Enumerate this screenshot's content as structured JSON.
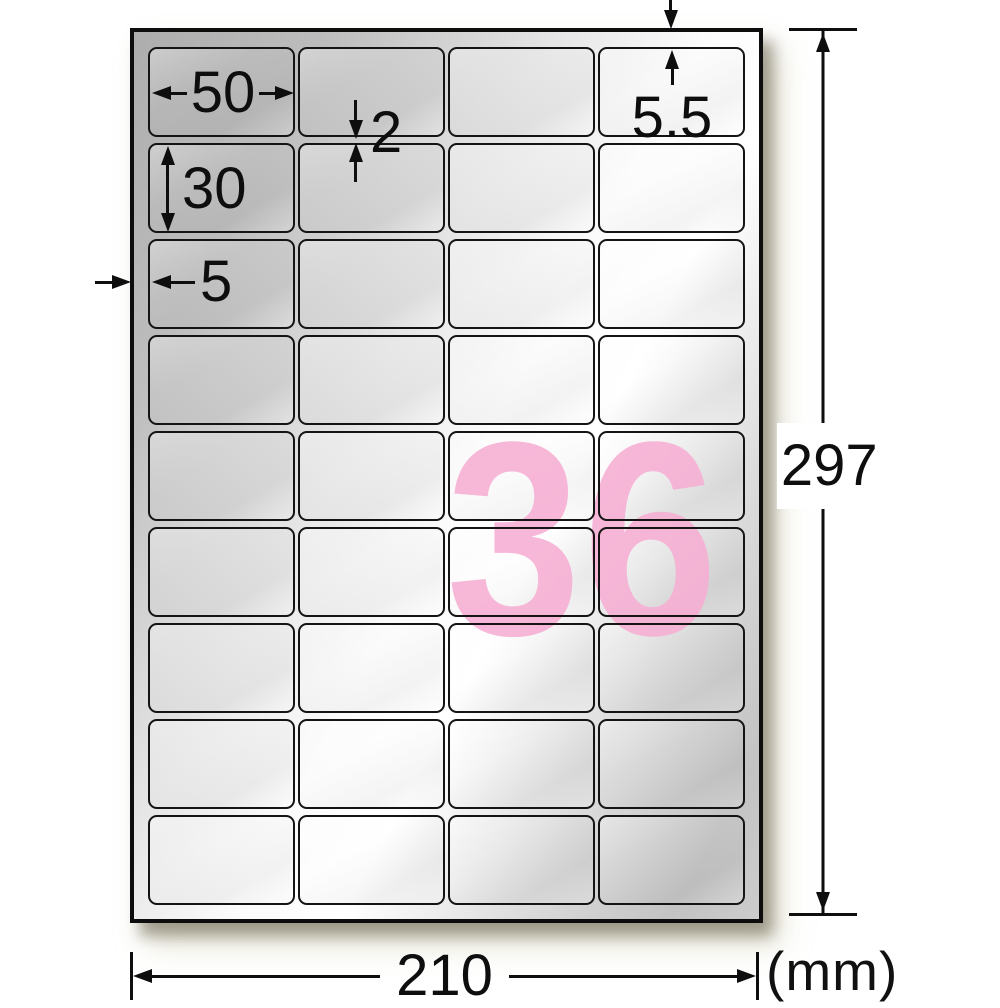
{
  "figure": {
    "kind": "label-sheet-dimension-diagram",
    "label_count": "36",
    "unit_note": "(mm)",
    "sheet": {
      "rows": 9,
      "cols": 4
    },
    "dimensions": {
      "label_width_mm": "50",
      "label_height_mm": "30",
      "row_gap_mm": "2",
      "side_margin_mm": "5",
      "top_margin_mm": "5.5",
      "sheet_width_mm": "210",
      "sheet_height_mm": "297"
    },
    "colors": {
      "count_pink": "#f7aed3",
      "line_black": "#0e0e0e",
      "label_silver": "#d9d9d9"
    }
  }
}
